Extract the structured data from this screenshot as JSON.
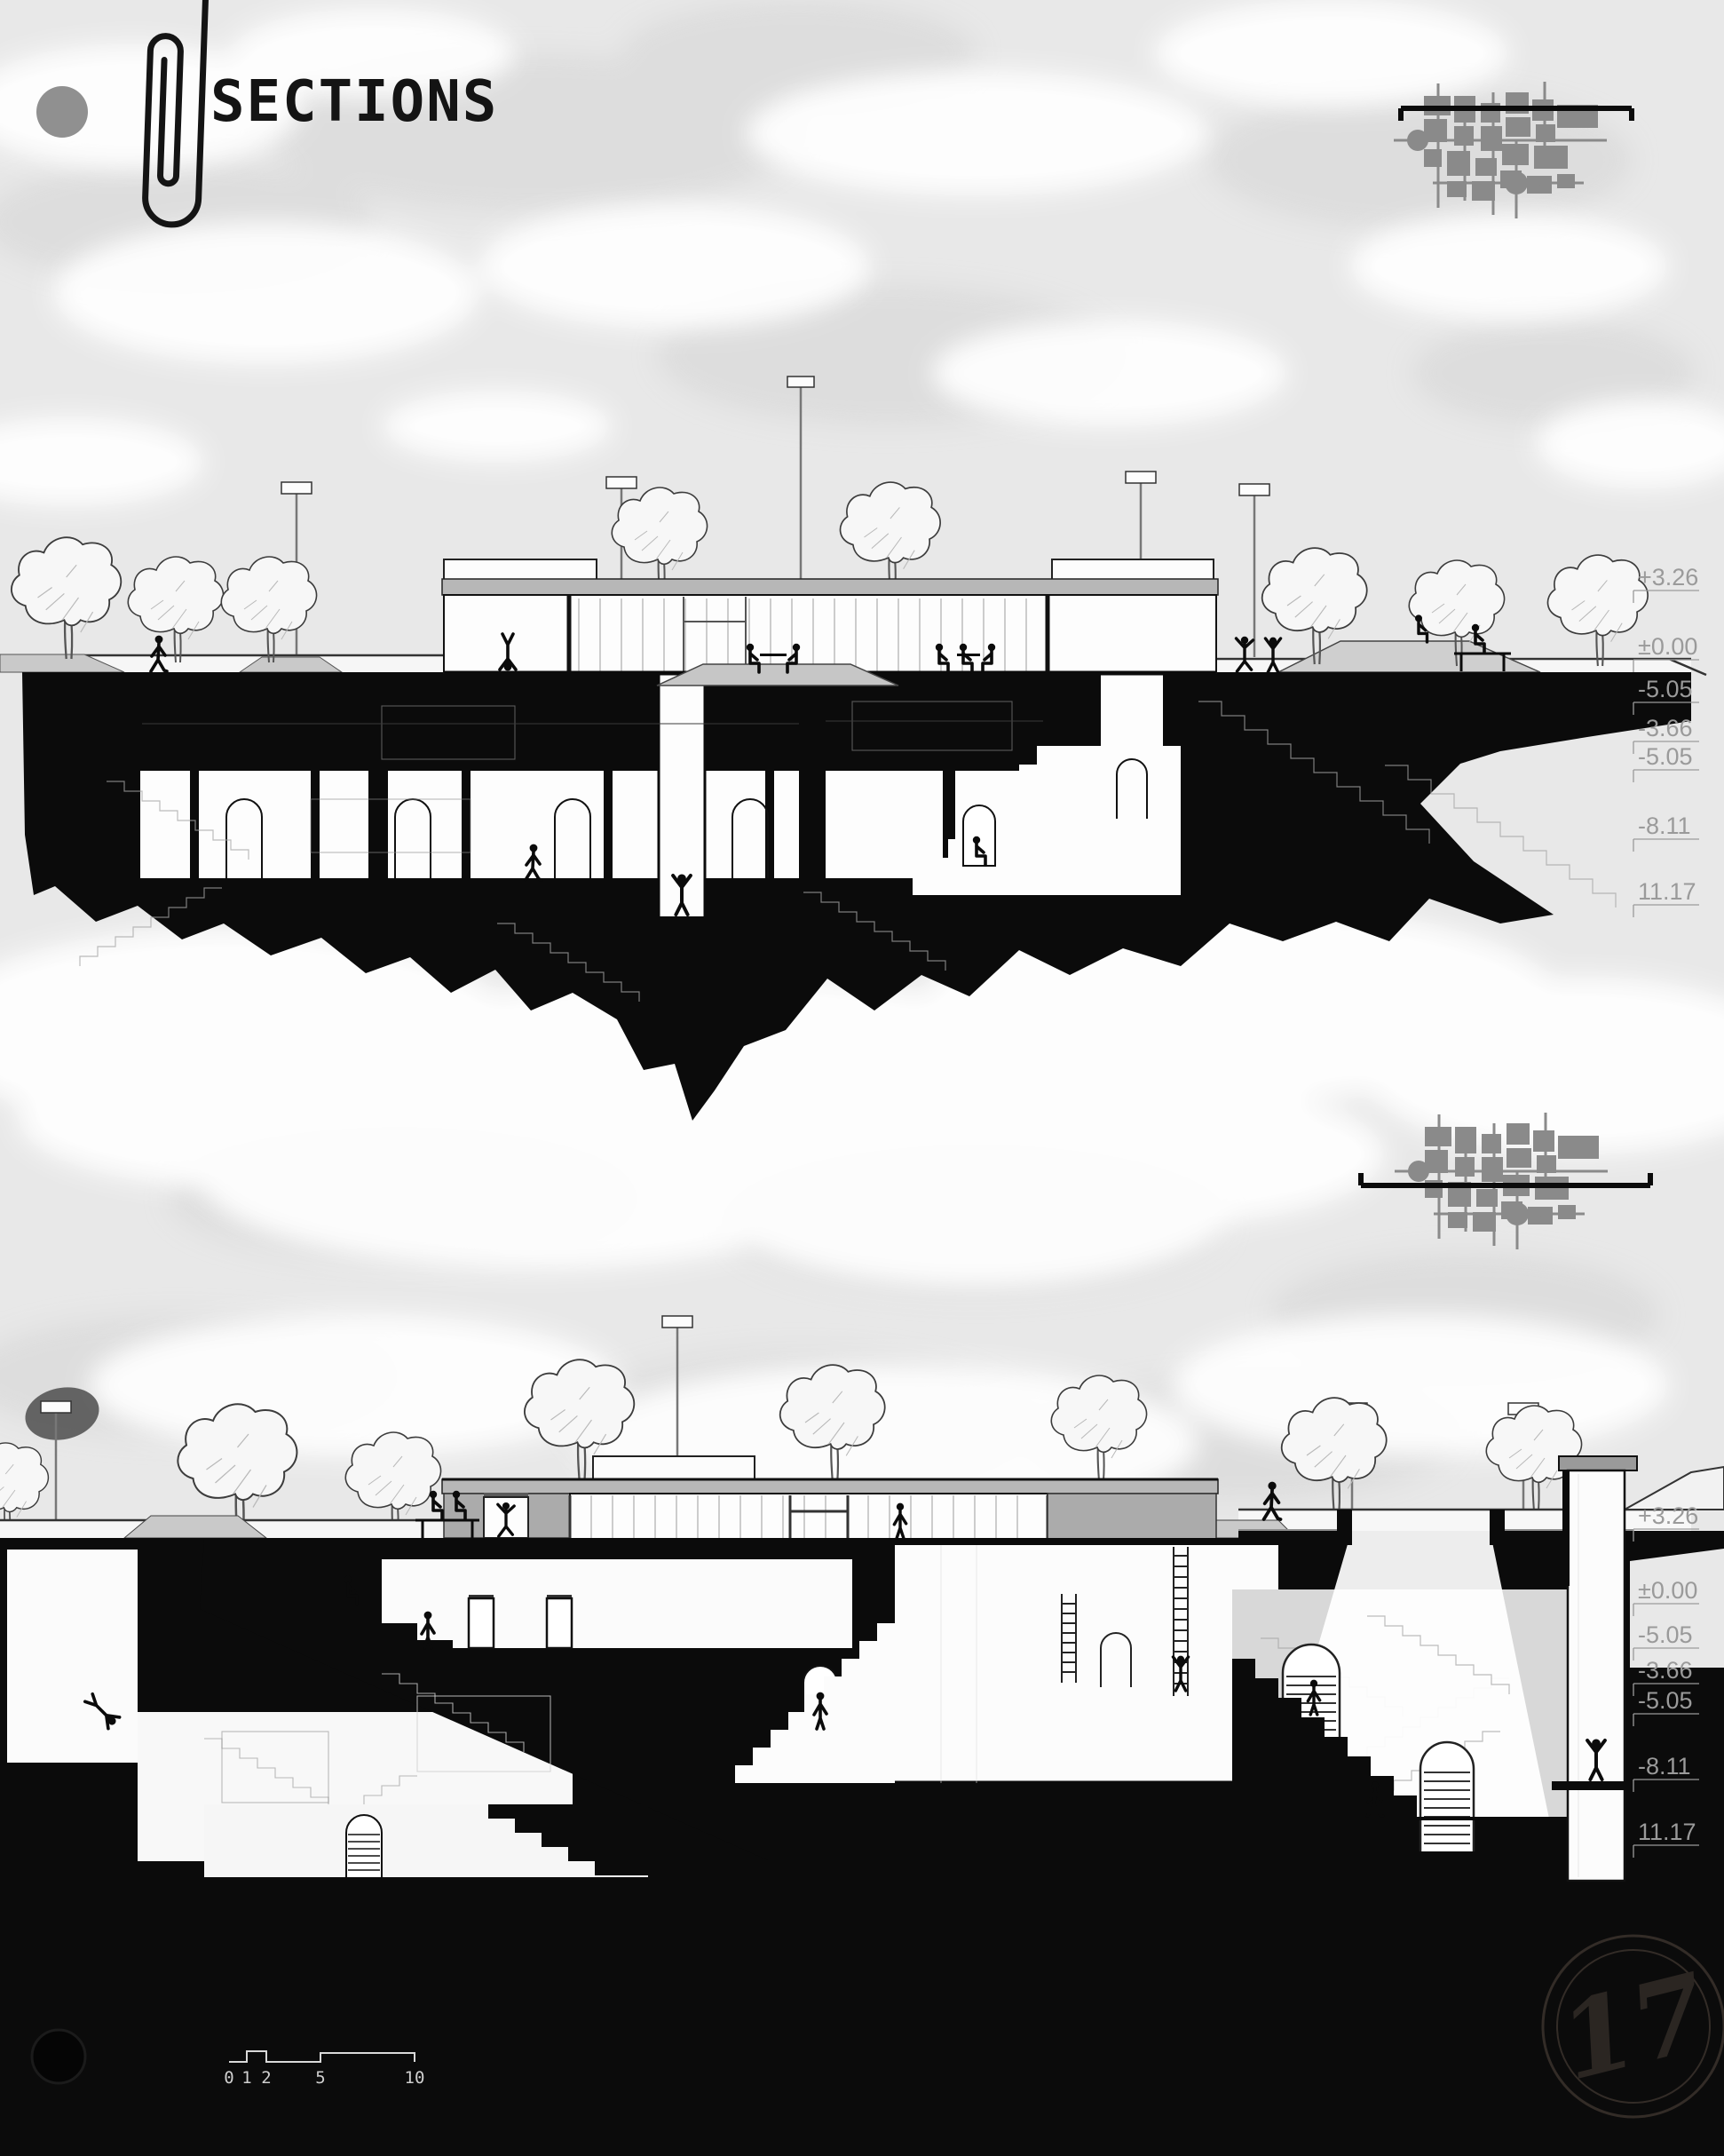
{
  "board": {
    "title_block": "SECTIONS",
    "background_color": "#e8e8e8",
    "ink_color": "#0b0b0b",
    "annotation_color": "#9a9a9a",
    "keyplan_color": "#8a8a8a",
    "roof_gray": "#b7b7b7"
  },
  "header": {
    "title": "SECTIONS"
  },
  "icons": {
    "paperclip": "paperclip-icon",
    "hole_punch": "hole-punch-dot",
    "site_key_plan": "site-plan-icon",
    "section_cut_line": "section-cut-line",
    "stamp": "page-stamp"
  },
  "sections": [
    {
      "id": "upper-section",
      "elevation_labels": [
        "+3.26",
        "±0.00",
        "-5.05",
        "-3.66",
        "-5.05",
        "-8.11",
        "11.17"
      ]
    },
    {
      "id": "lower-section",
      "elevation_labels": [
        "+3.26",
        "±0.00",
        "-5.05",
        "-3.66",
        "-5.05",
        "-8.11",
        "11.17"
      ]
    }
  ],
  "scale_bar": {
    "labels": [
      "0",
      "1",
      "2",
      "5",
      "10"
    ]
  },
  "stamp": {
    "number": "17"
  }
}
